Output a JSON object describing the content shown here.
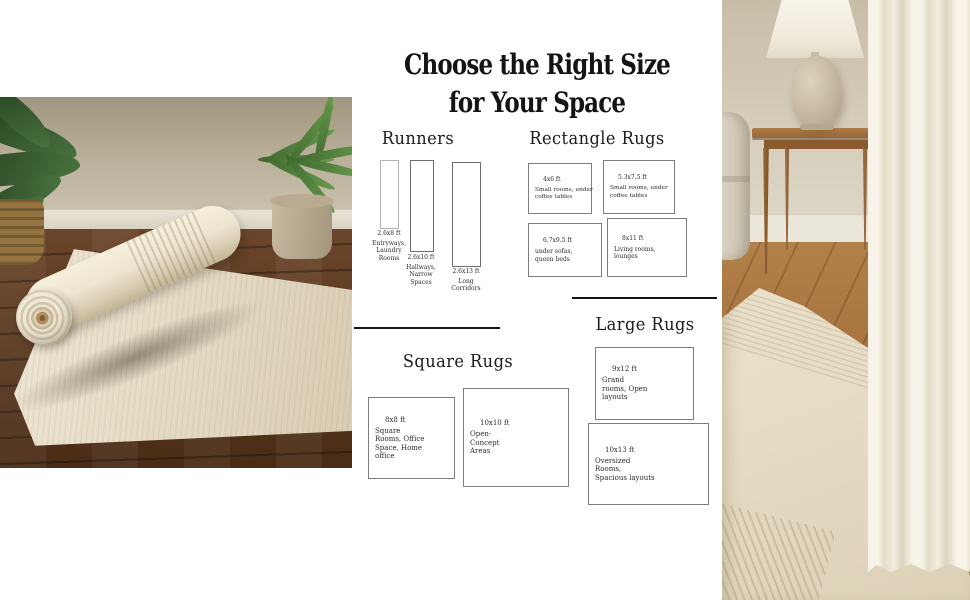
{
  "infographic": {
    "title_line1": "Choose the Right Size",
    "title_line2": "for Your Space",
    "runners": {
      "heading": "Runners",
      "items": [
        {
          "size": "2.6x8 ft",
          "use": "Entryways, Laundry Rooms"
        },
        {
          "size": "2.6x10 ft",
          "use": "Hallways, Narrow Spaces"
        },
        {
          "size": "2.6x13 ft",
          "use": "Long Corridors"
        }
      ]
    },
    "rectangle_rugs": {
      "heading": "Rectangle Rugs",
      "items": [
        {
          "size": "4x6 ft",
          "use": "Small rooms, under coffee tables"
        },
        {
          "size": "5.3x7.5 ft",
          "use": "Small rooms, under coffee tables"
        },
        {
          "size": "6.7x9.5 ft",
          "use": "under sofas, queen beds"
        },
        {
          "size": "8x11 ft",
          "use": "Living rooms, lounges"
        }
      ]
    },
    "square_rugs": {
      "heading": "Square Rugs",
      "items": [
        {
          "size": "8x8 ft",
          "use": "Square Rooms, Office Space, Home office"
        },
        {
          "size": "10x10 ft",
          "use": "Open-Concept Areas"
        }
      ]
    },
    "large_rugs": {
      "heading": "Large Rugs",
      "items": [
        {
          "size": "9x12 ft",
          "use": "Grand rooms, Open layouts"
        },
        {
          "size": "10x13 ft",
          "use": "Oversized Rooms, Spacious layouts"
        }
      ]
    }
  },
  "colors": {
    "panel_bg": "#ffffff",
    "text": "#1a1a1a",
    "box_border": "#7d7d7d",
    "rug_cream": "#e9e1cc",
    "wood_dark": "#5e3c22",
    "wood_mid": "#a87947",
    "wall_greige": "#b3a994",
    "wall_beige": "#d3cab7"
  }
}
